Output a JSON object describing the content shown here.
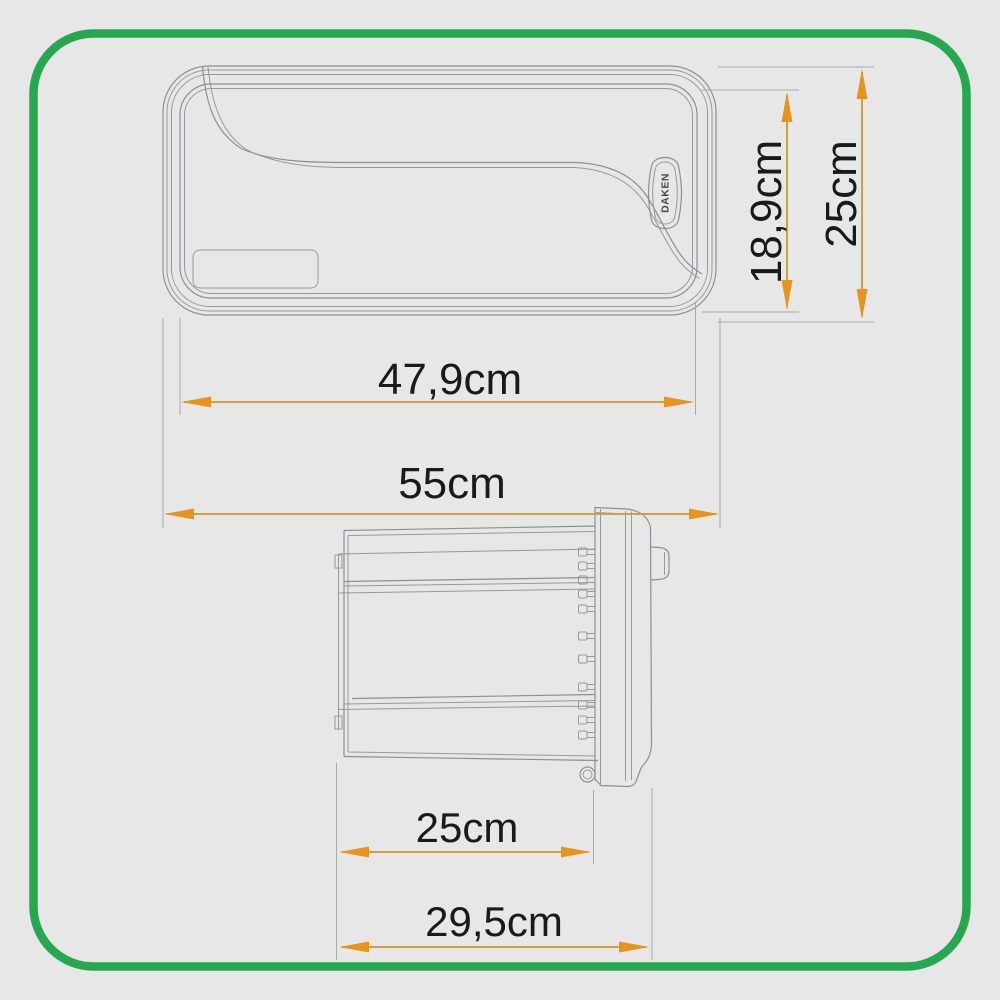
{
  "diagram": {
    "type": "product-dimension-drawing",
    "badge": "DAKEN",
    "front_view": {
      "label_width_inner": "47,9cm",
      "label_width_outer": "55cm",
      "label_height_inner": "18,9cm",
      "label_height_outer": "25cm"
    },
    "side_view": {
      "label_depth_inner": "25cm",
      "label_depth_outer": "29,5cm"
    },
    "colors": {
      "accent_green": "#28a752",
      "dimension_orange": "#e5941d",
      "dimension_shaft": "#cfa13c",
      "line_gray": "#8b9094",
      "text_black": "#1a1a1a",
      "background": "#e7e7e7"
    }
  }
}
